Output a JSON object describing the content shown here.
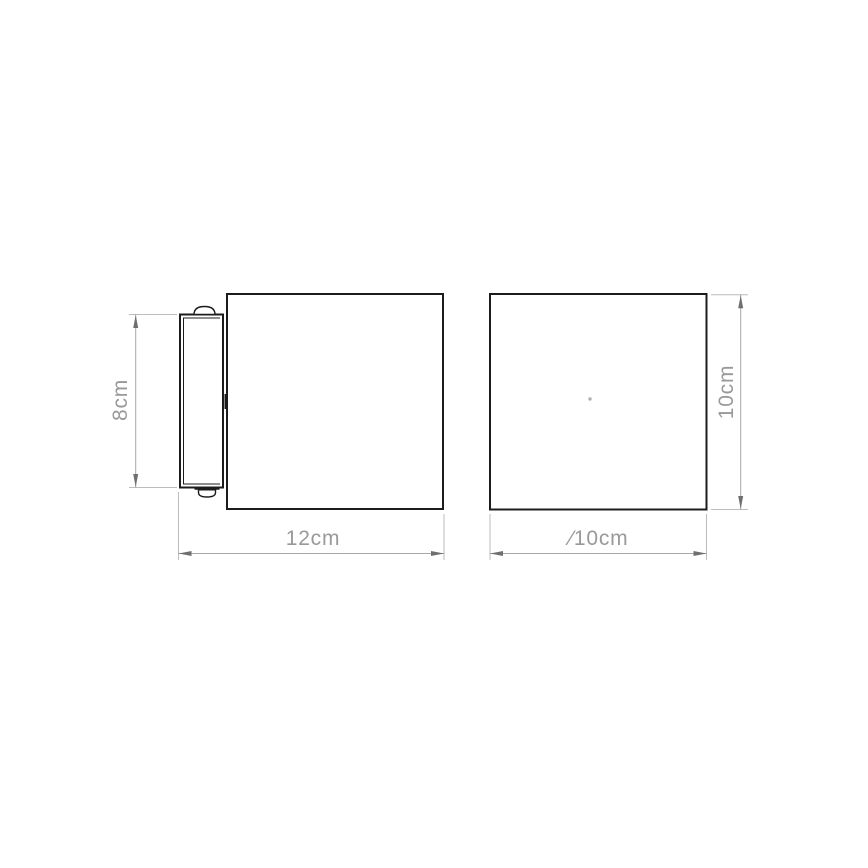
{
  "colors": {
    "background": "#ffffff",
    "outline": "#1c1c1c",
    "dim_line": "#a6a6a6",
    "ext_line": "#bcbcbc",
    "dim_text": "#999999",
    "arrow": "#6f6f6f",
    "center_mark": "#b0b0b0"
  },
  "views": {
    "side_view": {
      "dimensions": {
        "plate_height": {
          "label": "8cm"
        },
        "total_width": {
          "label": "12cm"
        }
      }
    },
    "front_view": {
      "dimensions": {
        "body_height": {
          "label": "10cm"
        },
        "body_diameter": {
          "label": "∕10cm"
        }
      }
    }
  }
}
